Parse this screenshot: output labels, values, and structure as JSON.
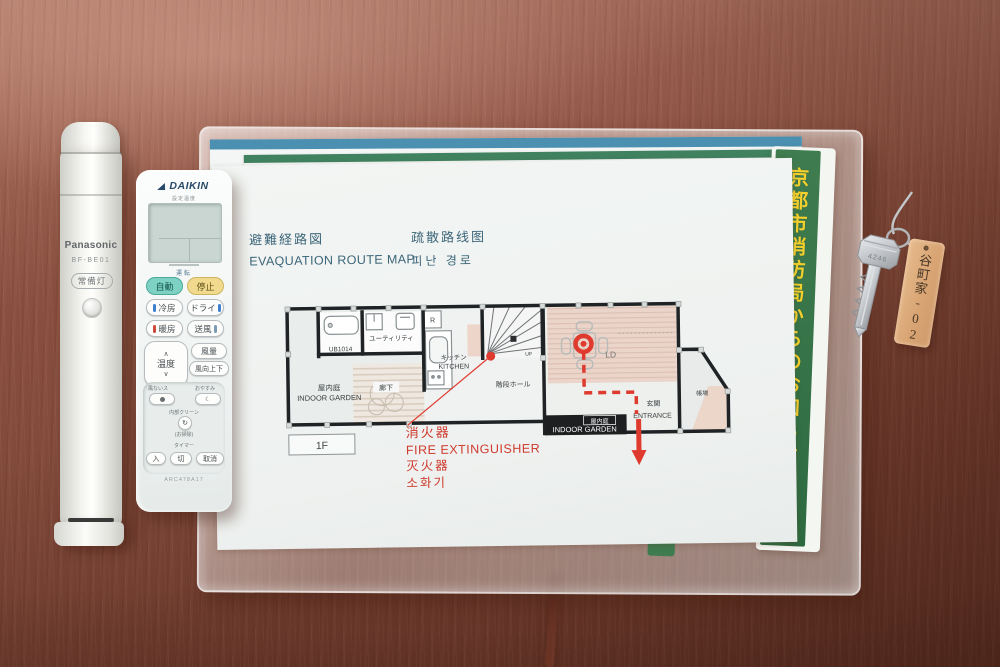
{
  "colors": {
    "route_red": "#df3a2e",
    "notice_green": "#3f7d50",
    "notice_yellow": "#f2d02e",
    "daikin_brand_blue": "#274a68",
    "auto_button_teal": "#7ed2c4",
    "stop_button_yellow": "#f1da8e",
    "wood_table": "#8d5242"
  },
  "icons": {
    "temp_up": "∧",
    "temp_down": "∨",
    "sleep_moon": "☾",
    "clean_cycle": "↻"
  },
  "flashlight": {
    "brand": "Panasonic",
    "model": "BF-BE01",
    "lamp_button": "常備灯"
  },
  "aircon_remote": {
    "brand": "DAIKIN",
    "lcd_caption": "設定温度",
    "operation": "運転",
    "auto": "自動",
    "stop": "停止",
    "cool": "冷房",
    "dry": "ドライ",
    "heat": "暖房",
    "fan": "送風",
    "temp": "温度",
    "fan_speed": "風量",
    "swing": "風向上下",
    "comfort": "風ないス",
    "sleep": "おやすみ",
    "clean": "内部クリーン",
    "clean_sub": "(お掃除)",
    "timer": "タイマー",
    "timer_on": "入",
    "timer_off": "切",
    "cancel": "取消",
    "model": "ARC478A17"
  },
  "map": {
    "title_jp": "避難経路図",
    "title_en": "EVAQUATION ROUTE MAP",
    "title_zh": "疏散路线图",
    "title_ko": "피난 경로",
    "floor": "1F",
    "rooms": {
      "bath": "UB1014",
      "utility": "ユーティリティ",
      "fridge": "R",
      "kitchen_jp": "キッチン",
      "kitchen_en": "KITCHEN",
      "garden_jp": "屋内庭",
      "garden_en": "INDOOR GARDEN",
      "corridor": "廊下",
      "stair_hall": "階段ホール",
      "up": "UP",
      "living": "LD",
      "entrance_jp": "玄関",
      "entrance_en": "ENTRANCE",
      "front_desk": "帳場",
      "garden_bar_jp": "屋内庭",
      "garden_bar_en": "INDOOR GARDEN"
    },
    "extinguisher": {
      "jp": "消火器",
      "en": "FIRE EXTINGUISHER",
      "zh": "灭火器",
      "ko": "소화기"
    }
  },
  "notice": {
    "text": "京都市消防局からのお知らせです。"
  },
  "keychain": {
    "tag": "谷町家-02",
    "key_number": "4246"
  }
}
